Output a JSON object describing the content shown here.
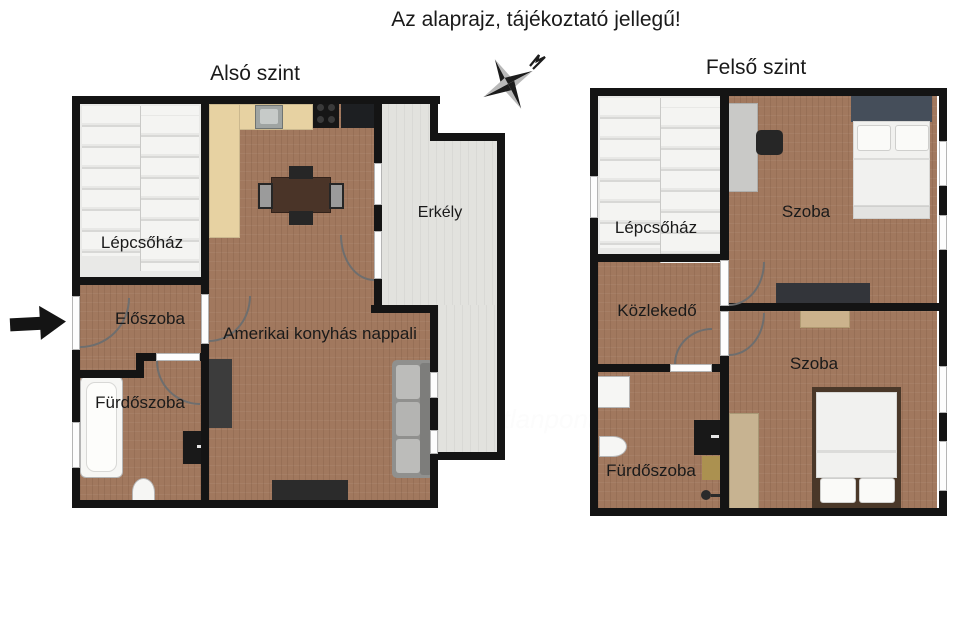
{
  "title": "Az alaprajz, tájékoztató jellegű!",
  "compass": {
    "icon": "compass-star-icon"
  },
  "watermark": {
    "logo_icon": "otp-ring-logo-icon",
    "brand": "otp",
    "suffix": "Ingatlanpont"
  },
  "lower_plan": {
    "heading": "Alsó szint",
    "entrance_arrow_icon": "entrance-arrow-icon",
    "rooms": {
      "staircase": "Lépcsőház",
      "hall": "Előszoba",
      "bathroom": "Fürdőszoba",
      "living": "Amerikai konyhás nappali",
      "balcony": "Erkély"
    }
  },
  "upper_plan": {
    "heading": "Felső szint",
    "rooms": {
      "staircase": "Lépcsőház",
      "corridor": "Közlekedő",
      "bathroom": "Fürdőszoba",
      "room_top": "Szoba",
      "room_bottom": "Szoba"
    }
  },
  "colors": {
    "wall": "#141414",
    "wood_floor": "#a1785e",
    "light_floor": "#e9e9e7",
    "balcony_floor": "#e2e2de",
    "kitchen_counter": "#e7d2a2",
    "dark_furniture": "#2f2f2f",
    "sofa_gray": "#90908e",
    "bed_linen": "#f1f1ef",
    "headboard_slate": "#454e5a",
    "bed_frame_brown": "#4a3829",
    "tan_wood": "#c7b391",
    "text": "#1a1a1a"
  }
}
